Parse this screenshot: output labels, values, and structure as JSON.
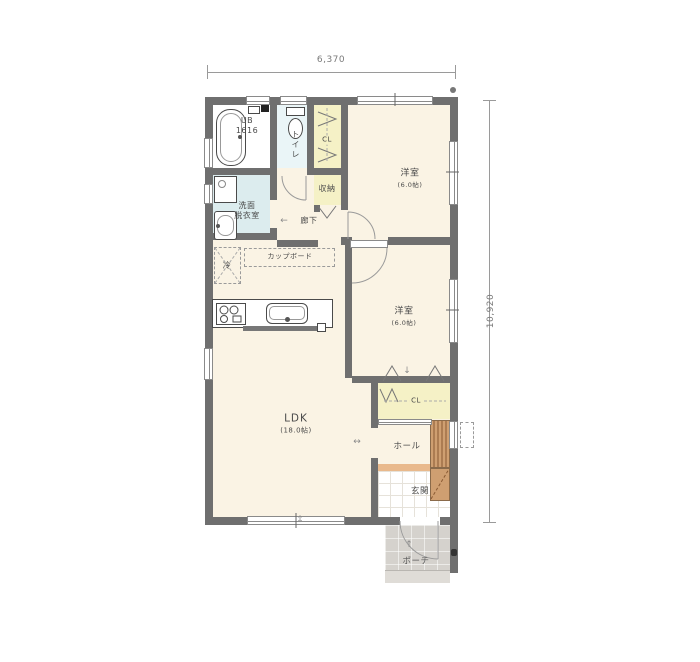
{
  "dimensions": {
    "width_label": "6,370",
    "height_label": "10,920"
  },
  "rooms": {
    "bath": {
      "line1": "UB",
      "line2": "1616"
    },
    "toilet": {
      "label": "トイレ"
    },
    "closet1": {
      "label": "CL"
    },
    "storage": {
      "label": "収納"
    },
    "bedroom1": {
      "label": "洋室",
      "size": "(6.0帖)"
    },
    "washroom": {
      "line1": "洗面",
      "line2": "脱衣室"
    },
    "hallway": {
      "label": "廊下"
    },
    "kitchen": {
      "cupboard": "カップボード",
      "fridge": "冷"
    },
    "ldk": {
      "label": "LDK",
      "size": "(18.0帖)"
    },
    "bedroom2": {
      "label": "洋室",
      "size": "(6.0帖)"
    },
    "closet2": {
      "label": "CL"
    },
    "hall": {
      "label": "ホール"
    },
    "entrance": {
      "label": "玄関"
    },
    "porch": {
      "label": "ポーチ"
    }
  },
  "icons": {
    "arrow_left": "←",
    "arrow_up": "↑",
    "arrow_down": "↓",
    "arrow_horizontal": "↔",
    "arrow_vertical": "↕"
  },
  "colors": {
    "wall": "#6f6f6f",
    "floor": "#faf3e4",
    "closet": "#f5f1c6",
    "washroom_floor": "#dcecee",
    "toilet_floor": "#eaf5f7",
    "stairs": "#cf9f71",
    "entry_step": "#e9b98c",
    "porch": "#d5d2cd"
  }
}
